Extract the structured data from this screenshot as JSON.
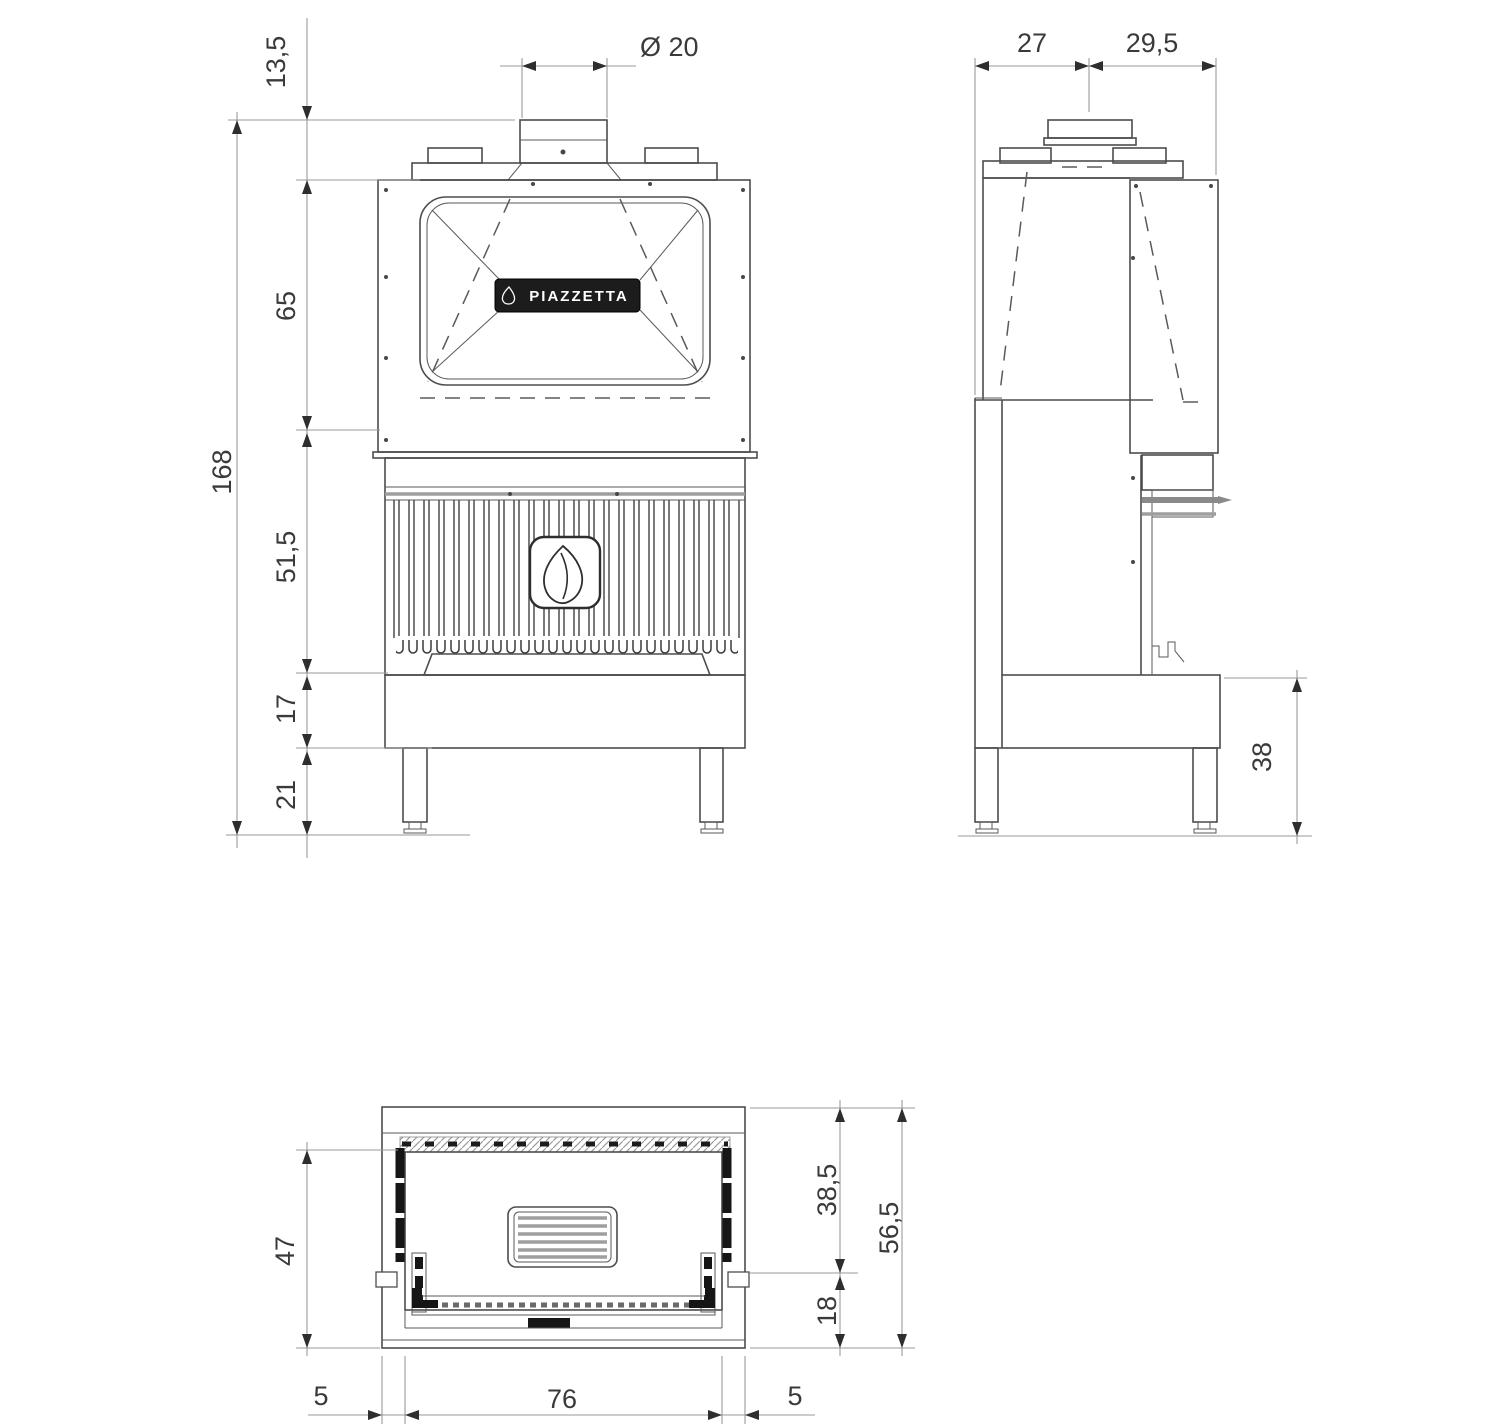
{
  "brand": {
    "label": "PIAZZETTA"
  },
  "dims": {
    "front": {
      "offset_top": "13,5",
      "flue_diameter": "Ø 20",
      "hood_height": "65",
      "total_height": "168",
      "firebox_height": "51,5",
      "plinth_height": "17",
      "leg_height": "21"
    },
    "side": {
      "front_depth": "27",
      "rear_depth": "29,5",
      "base_height": "38"
    },
    "top": {
      "inner_depth": "47",
      "front_depth": "38,5",
      "total_depth": "56,5",
      "rear_depth": "18",
      "left_side": "5",
      "opening_width": "76",
      "right_side": "5"
    }
  },
  "colors": {
    "line": "#4d4d4d",
    "dimension_line": "#9a9a9a",
    "text": "#3a3a3a",
    "background": "#ffffff",
    "plate": "#1c1c1c"
  }
}
